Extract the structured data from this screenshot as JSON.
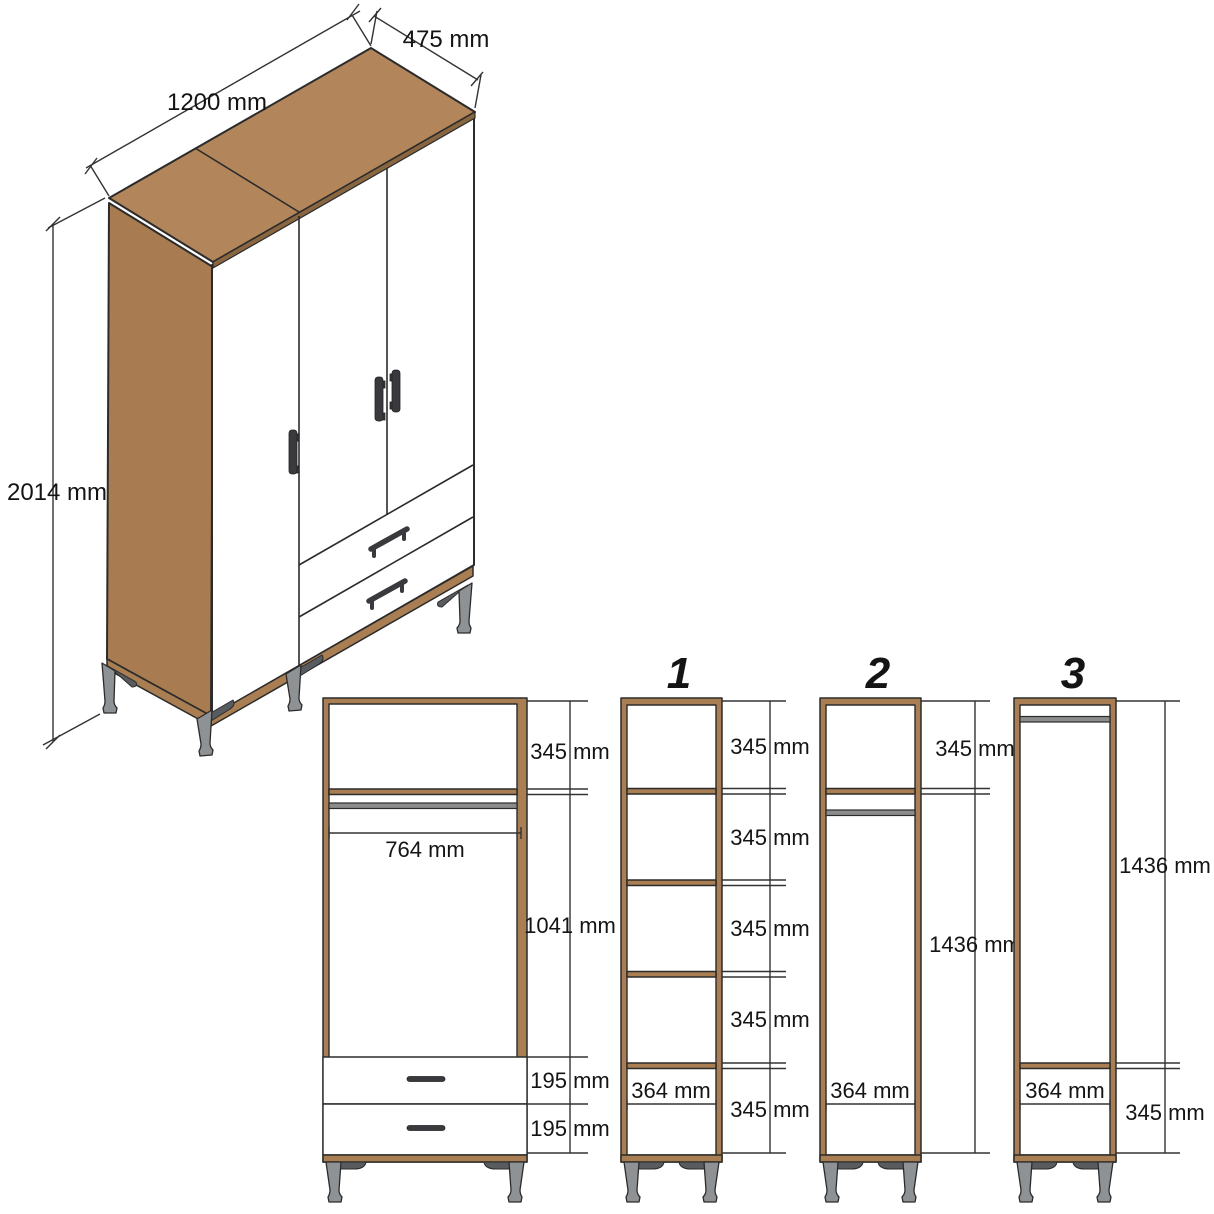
{
  "colors": {
    "wood_top": "#B2865A",
    "wood_side": "#A87C50",
    "wood_frame": "#A97E52",
    "wood_edge": "#8A6640",
    "outline": "#2B2B2B",
    "metal_rod": "#8C8C8C",
    "leg_light": "#8F9294",
    "leg_dark": "#595C5E",
    "handle": "#3A3A3E",
    "dimension_line": "#333333",
    "text_color": "#141414",
    "background": "#FFFFFF"
  },
  "isometric_view": {
    "width": "1200 mm",
    "depth": "475 mm",
    "height": "2014 mm"
  },
  "front_view": {
    "top_compartment_height": "345 mm",
    "inner_width": "764 mm",
    "hanging_area_height": "1041 mm",
    "upper_drawer_height": "195 mm",
    "lower_drawer_height": "195 mm"
  },
  "sections": [
    {
      "label": "1",
      "compartments": [
        "345 mm",
        "345 mm",
        "345 mm",
        "345 mm",
        "345 mm"
      ],
      "inner_width": "364 mm"
    },
    {
      "label": "2",
      "top_compartment": "345 mm",
      "hanging_space": "1436 mm",
      "inner_width": "364 mm"
    },
    {
      "label": "3",
      "hanging_space": "1436 mm",
      "bottom_compartment": "345 mm",
      "inner_width": "364 mm"
    }
  ]
}
